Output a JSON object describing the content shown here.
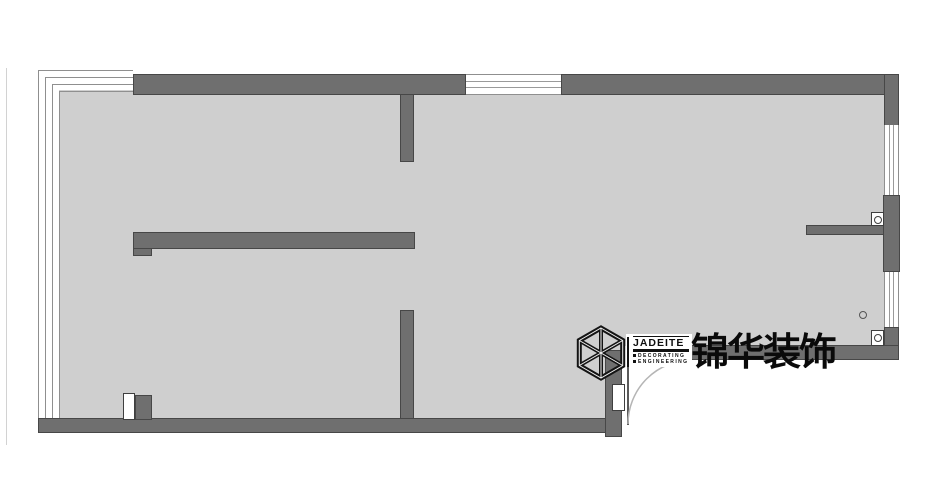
{
  "document": {
    "type": "architectural floor plan",
    "title": "apartment floor plan drawing"
  },
  "colors": {
    "background": "#ffffff",
    "floor": "#cfcfcf",
    "wall_fill": "#6f6f6f",
    "wall_outline": "#474545",
    "window_line": "#8f8f8f",
    "door_arc": "#b5b5b5",
    "logo_black": "#111111"
  },
  "brand": {
    "icon": "jadeite-cube-logo-icon",
    "name_en": "JADEITE",
    "tagline_line1": "DECORATING",
    "tagline_line2": "ENGINEERING",
    "name_cn": "锦华装饰"
  },
  "plan": {
    "features": [
      "corner-bay-window-top-left",
      "top-wall-window",
      "right-wall-window-upper",
      "right-wall-window-lower",
      "entry-door-with-swing-arc",
      "wall-outlet-upper",
      "wall-outlet-lower",
      "floor-drain",
      "interior-partition-walls"
    ]
  }
}
